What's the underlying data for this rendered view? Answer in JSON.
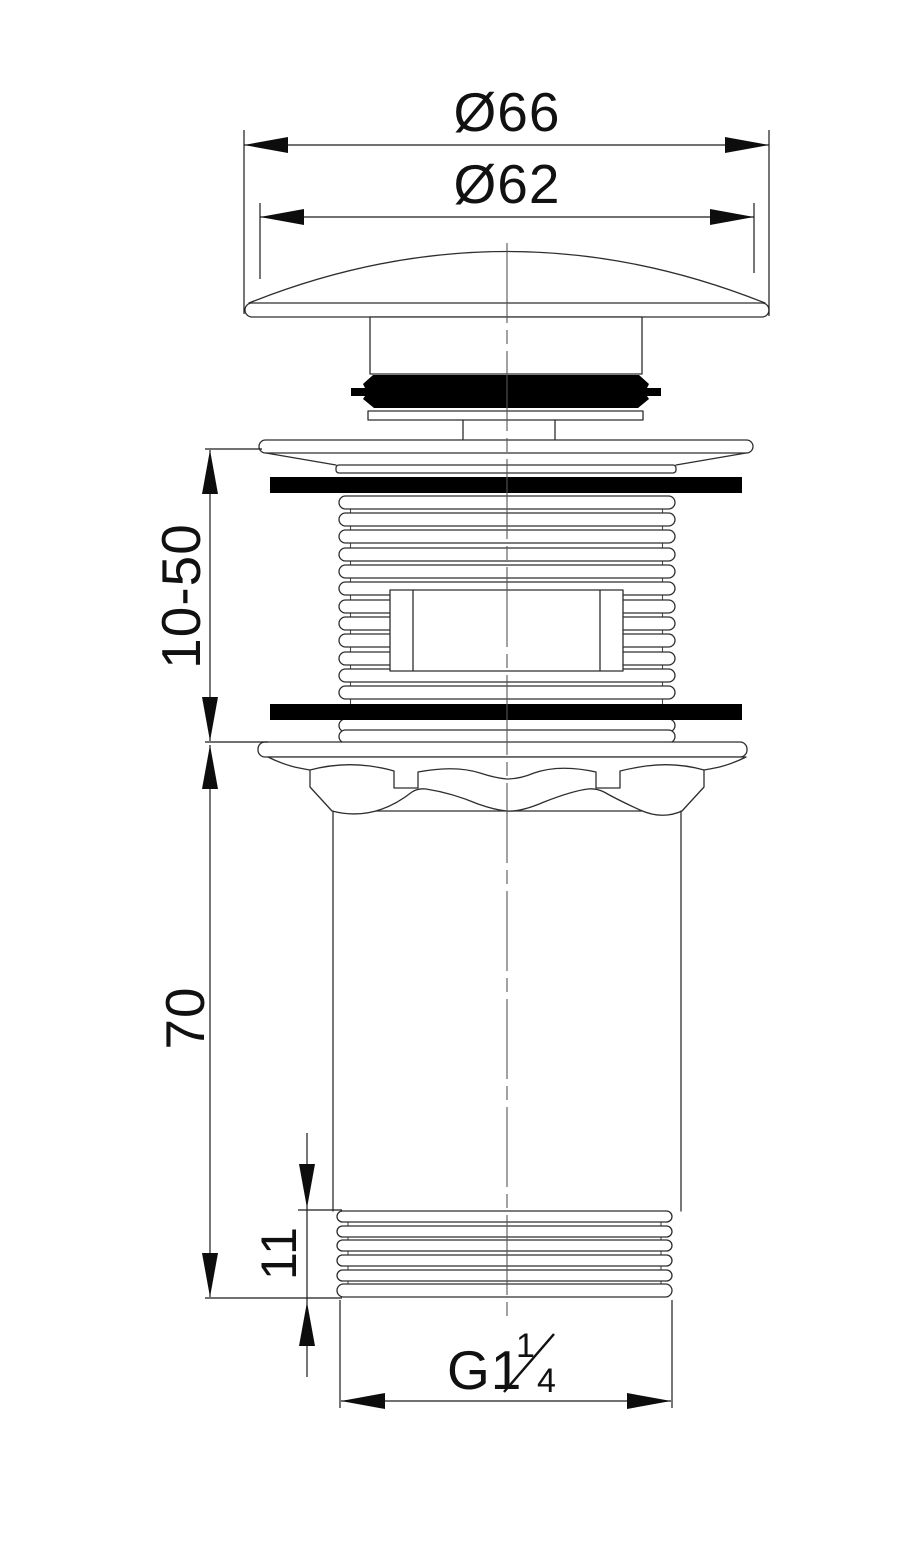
{
  "dimensions": {
    "cap_outer_diameter": {
      "label": "Ø66"
    },
    "cap_inner_diameter": {
      "label": "Ø62"
    },
    "adjustment_range": {
      "label": "10-50"
    },
    "body_length": {
      "label": "70"
    },
    "lower_thread_length": {
      "label": "11"
    },
    "thread_spec": {
      "prefix": "G1",
      "fraction_numerator": "1",
      "fraction_denominator": "4"
    }
  },
  "colors": {
    "background": "#ffffff",
    "line": "#2e2e2e",
    "dimension": "#111111",
    "solid_fill": "#000000"
  }
}
